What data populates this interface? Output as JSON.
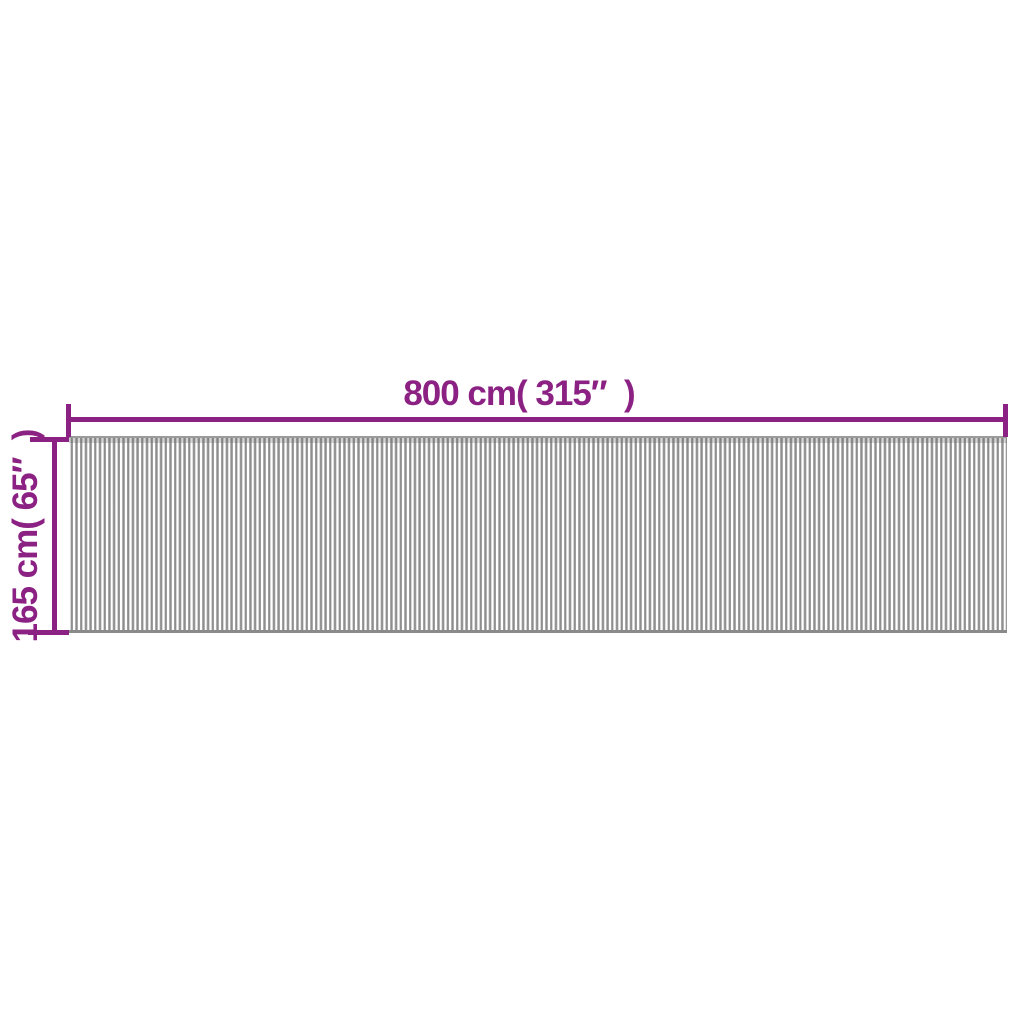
{
  "dimension_diagram": {
    "type": "product-dimension-diagram",
    "width_dimension": {
      "label": "800 cm( 315″  )",
      "value_cm": 800,
      "value_inches": 315
    },
    "height_dimension": {
      "label": "165 cm( 65″  )",
      "value_cm": 165,
      "value_inches": 65
    },
    "colors": {
      "annotation": "#8B2182",
      "slat-dark": "#8E8E8E",
      "slat-light": "#C9C9C9",
      "mat-edge": "#8A8A8A",
      "background": "#FFFFFF"
    }
  }
}
